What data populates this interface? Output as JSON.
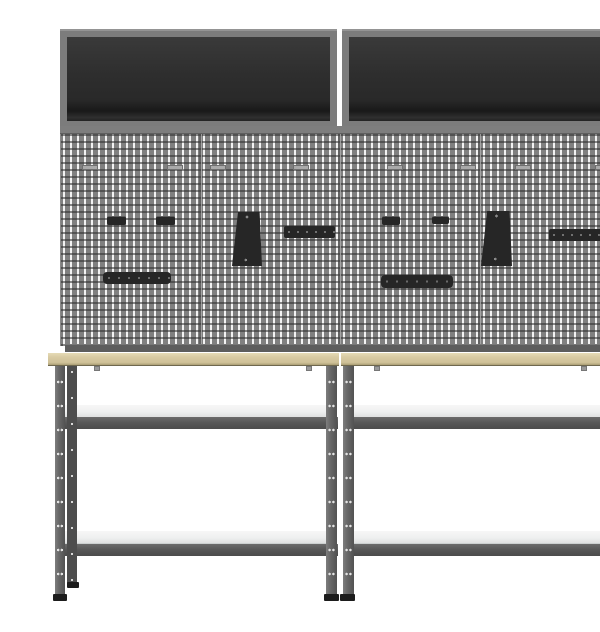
{
  "scene": {
    "type": "product-photo",
    "subject": "Two workbenches with wooden tops, four perforated pegboard wall panels with hanging tool holders, and two grey wall cabinets with dark open fronts on a white background",
    "background_label": "white studio background"
  },
  "colors": {
    "background": "#ffffff",
    "cabinet_frame": "#7c7c7c",
    "cabinet_interior": "#2e2e2e",
    "pegboard_base": "#9a9a9a",
    "pegboard_rail": "#7e7e7e",
    "accessory_black": "#262626",
    "worktop": "#d8caa3",
    "leg_front": "#6a6a6a",
    "leg_rear": "#4d4d4d",
    "rail": "#585858",
    "shelf": "#eff0f0",
    "foot": "#1c1c1c"
  },
  "components": {
    "wall_cabinets": {
      "count": 2,
      "label": "wall cabinet with open dark front"
    },
    "pegboard_panels": {
      "count": 4,
      "label": "grey perforated pegboard panel"
    },
    "workbenches": {
      "count": 2,
      "label": "height-adjustable workbench with wooden top and two light-grey shelves"
    },
    "accessories": [
      {
        "name": "small-hook",
        "count": 4
      },
      {
        "name": "drill-holder",
        "count": 2
      },
      {
        "name": "tool-strip",
        "count": 2
      },
      {
        "name": "tool-bar",
        "count": 2
      }
    ]
  }
}
